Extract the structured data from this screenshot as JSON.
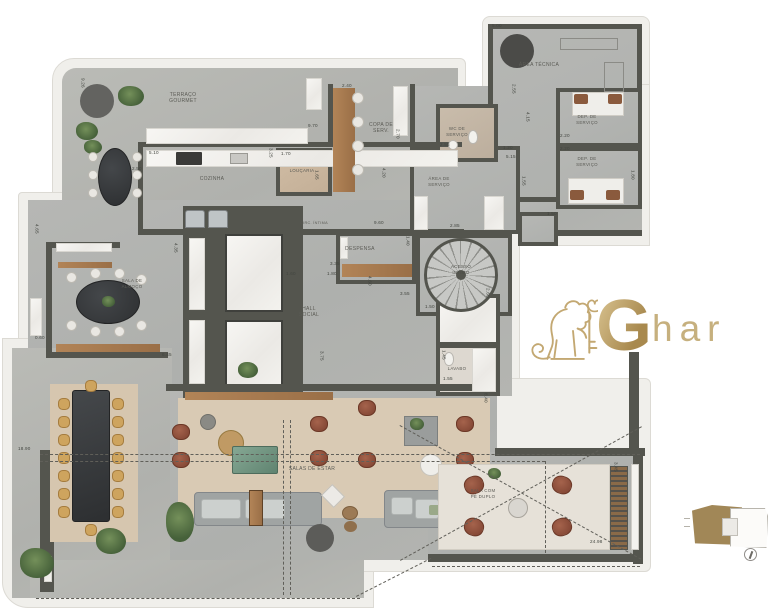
{
  "plan": {
    "rooms": {
      "terraco_gourmet": "TERRAÇO\nGOURMET",
      "cozinha": "COZINHA",
      "copa": "COPA DE\nSERV.",
      "loucaria": "LOUÇARIA",
      "wc_servico": "WC DE\nSERVIÇO",
      "area_tecnica": "ÁREA TÉCNICA",
      "dep_servico_1": "DEP. DE\nSERVIÇO",
      "dep_servico_2": "DEP. DE\nSERVIÇO",
      "area_servico": "ÁREA DE\nSERVIÇO",
      "despensa": "DESPENSA",
      "circ_intima": "CIRC. ÍNTIMA",
      "acesso_intimo": "ACESSO\nÍNTIMO",
      "hall_social": "HALL\nSOCIAL",
      "lavabo": "LAVABO",
      "sala_almoco": "SALA DE\nALMOÇO",
      "salas_estar": "SALAS DE ESTAR",
      "sala_pe_duplo": "SALA COM\nPÉ DUPLO"
    },
    "dimensions": [
      "5.00",
      "9.26",
      "2.40",
      "9.70",
      "5.10",
      "2.50",
      "1.70",
      "3.25",
      "1.65",
      "2.70",
      "2.55",
      "4.20",
      "2.55",
      "4.15",
      "1.20",
      "5.15",
      "1.55",
      "2.20",
      "2.20",
      "1.80",
      "1.50",
      "2.85",
      "9.60",
      "1.40",
      "3.35",
      "1.60",
      "1.80",
      "4.60",
      "3.55",
      "1.50",
      "2.60",
      "1.45",
      "1.55",
      "4.65",
      "0.60",
      "6.45",
      "4.35",
      "3.75",
      "8.40",
      "18.90",
      "3.45",
      "24.98"
    ]
  },
  "logo": {
    "g": "G",
    "suffix": "har"
  },
  "colors": {
    "gold": "#c3a86f",
    "wall": "#54554e",
    "floor": "#b2b3b0",
    "rug": "#d9cab4",
    "wood": "#a87c52"
  }
}
